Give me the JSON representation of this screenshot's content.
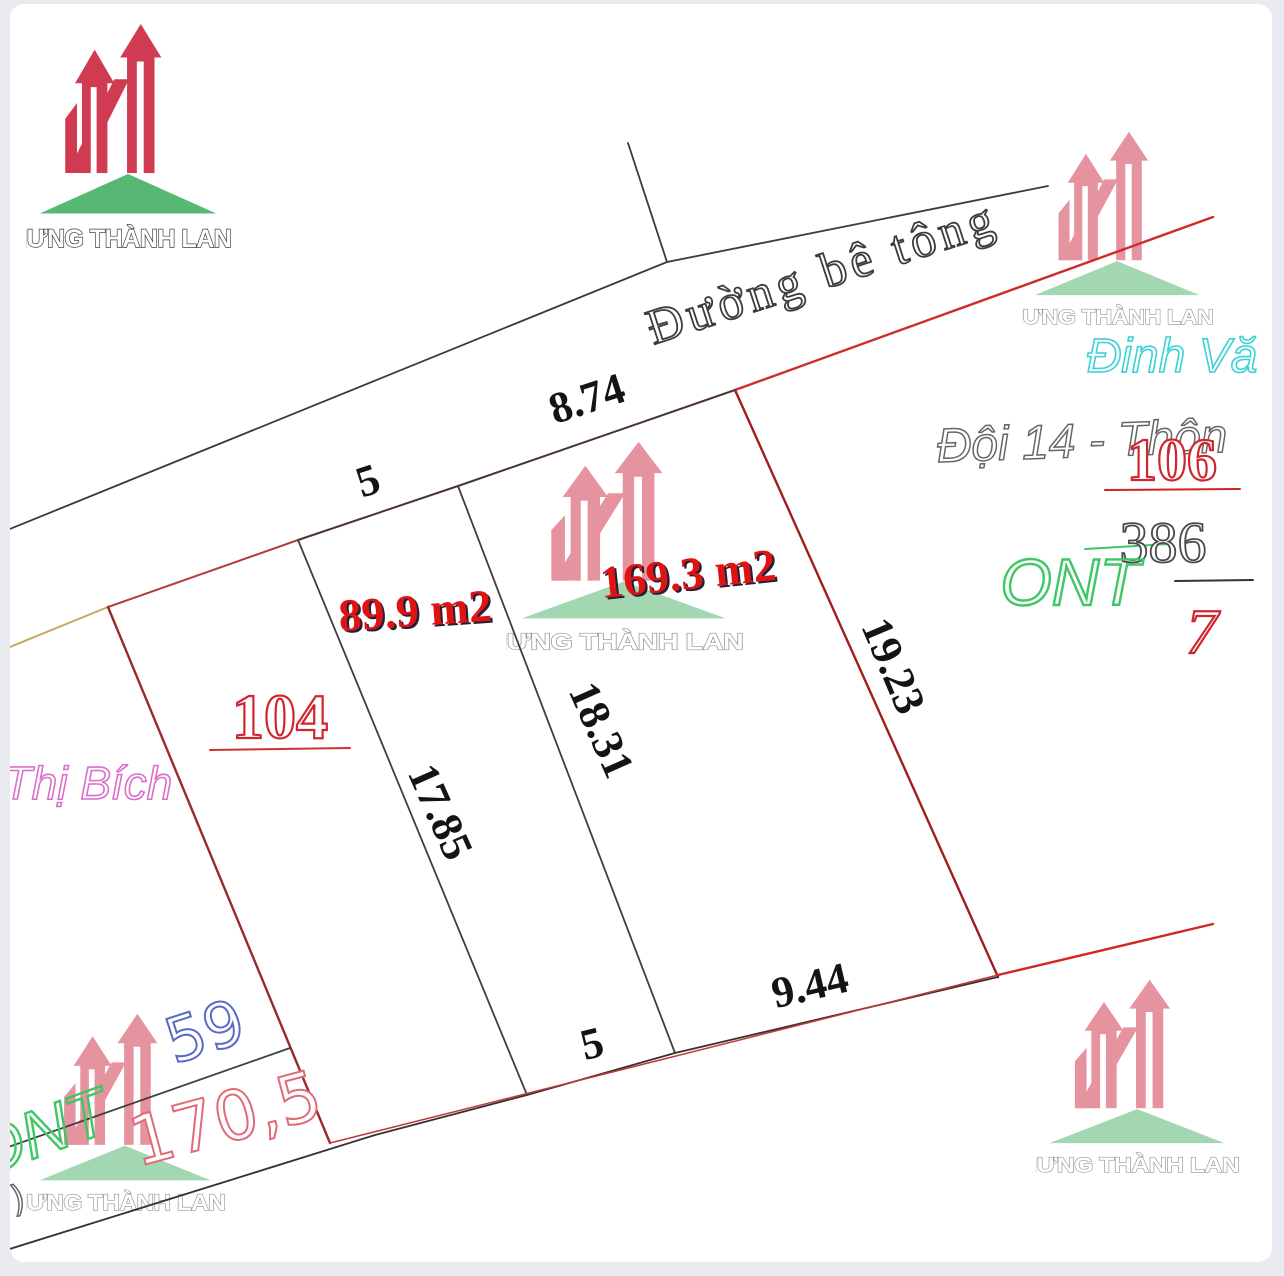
{
  "colors": {
    "logo_red": "#d13b52",
    "logo_green": "#57b873",
    "boundary_red": "#cc2222",
    "measure_black": "#141414",
    "area_red": "#e01313"
  },
  "logo": {
    "text": "HƯNG THÀNH LAND"
  },
  "road": {
    "name": "Đường bê tông"
  },
  "parcels": {
    "strip_a": {
      "area": "89.9 m2",
      "top": "5",
      "side_left": "17.85",
      "side_right": "18.31",
      "bottom": "5"
    },
    "strip_b": {
      "area": "169.3 m2",
      "top": "8.74",
      "side_right": "19.23",
      "bottom": "9.44"
    },
    "plot_104": {
      "number": "104",
      "owner": "Thị Bích"
    },
    "plot_106": {
      "number": "106",
      "area": "386",
      "denominator": "7",
      "land_use": "ONT",
      "owner": "Đinh Vă",
      "address": "Đội 14 - Thôn"
    },
    "plot_59": {
      "number": "59",
      "area": "170,5",
      "land_use": "ONT"
    }
  },
  "fragments": {
    "edge_mark": ")"
  }
}
